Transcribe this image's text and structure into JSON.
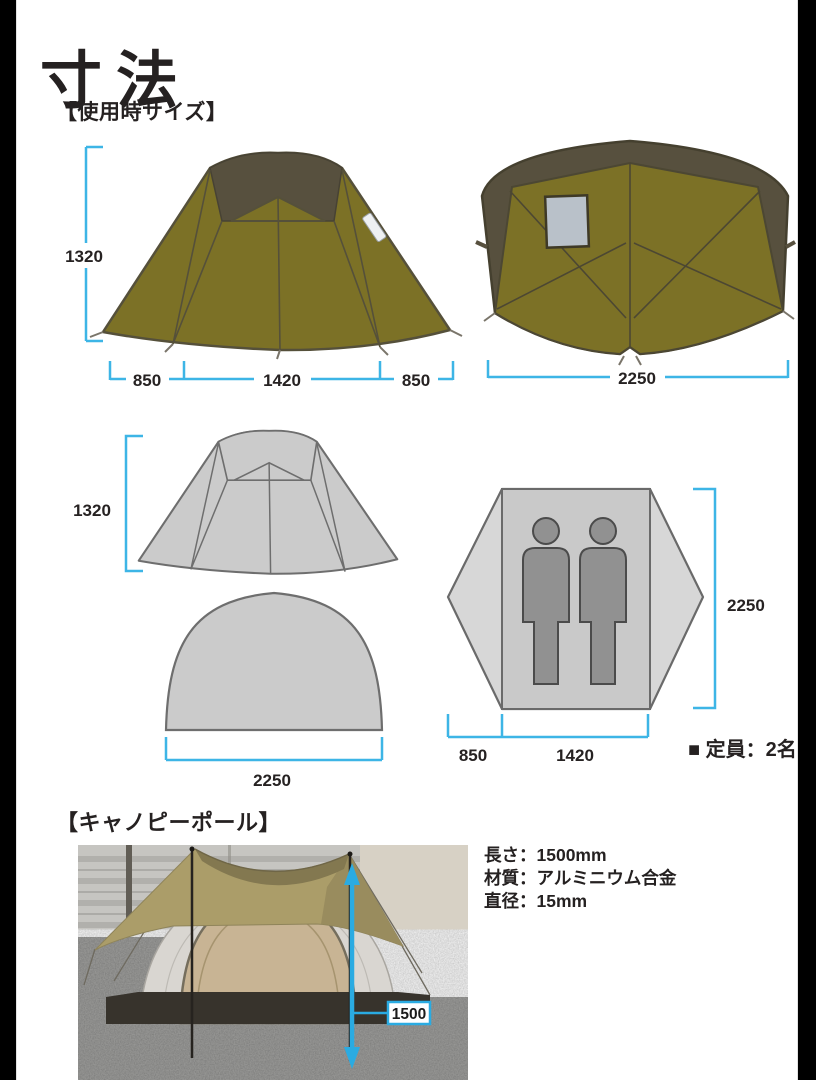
{
  "page": {
    "title": "寸法"
  },
  "colors": {
    "dimension_line_blue": "#3db5e6",
    "tent_body_olive": "#7c7126",
    "tent_cap_dark": "#57503e",
    "gray_diagram_fill": "#cbcbcb",
    "floorplan_fill": "#d7d7d7",
    "person_gray": "#919191",
    "photo_arrow_cyan": "#2aabe2",
    "text_black": "#252121"
  },
  "sections": {
    "usage_size": {
      "header": "【使用時サイズ】",
      "side_view": {
        "height_label": "1320",
        "bottom_labels": [
          "850",
          "1420",
          "850"
        ]
      },
      "rear_view": {
        "width_label": "2250"
      },
      "gray_side_view": {
        "height_label": "1320"
      },
      "gray_door_panel": {
        "width_label": "2250"
      },
      "floor_plan": {
        "depth_label": "2250",
        "bottom_labels": [
          "850",
          "1420"
        ]
      },
      "capacity_note": "■ 定員：2名"
    },
    "canopy_pole": {
      "header": "【キャノピーポール】",
      "photo_dim_label": "1500",
      "specs": [
        "長さ：1500mm",
        "材質：アルミニウム合金",
        "直径：15mm"
      ]
    }
  }
}
